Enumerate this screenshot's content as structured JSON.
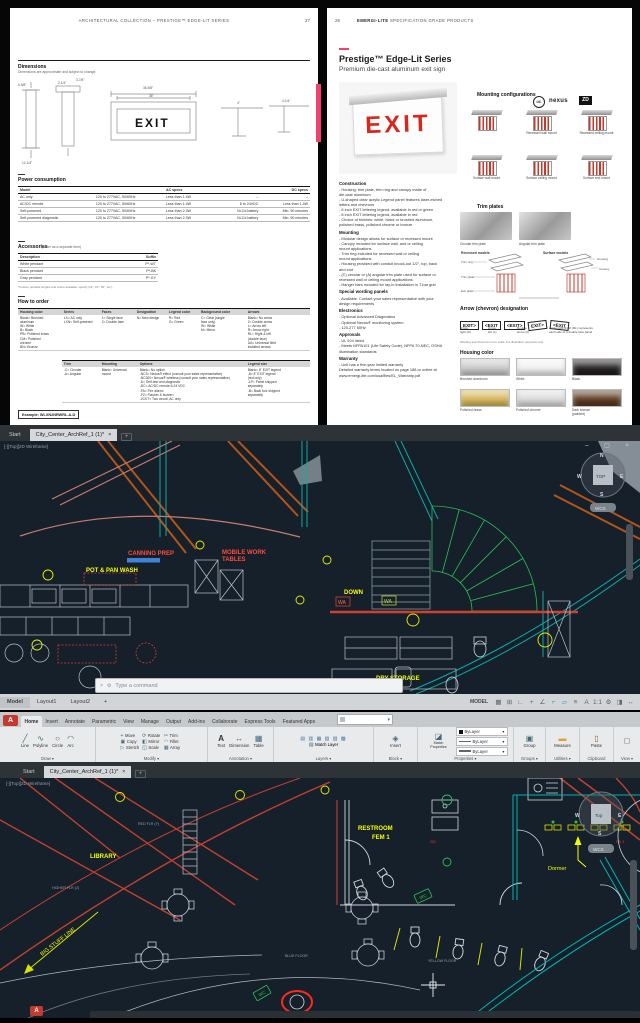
{
  "doc_left": {
    "header": "ARCHITECTURAL COLLECTION – PRESTIGE™ EDGE-LIT SERIES",
    "page_number": "27",
    "dimensions_title": "Dimensions",
    "dimensions_note": "Dimensions are approximate and subject to change.",
    "exit_label": "EXIT",
    "dims": {
      "d1": "6-5/8\"",
      "d2": "2-1/4\"",
      "d3": "36-5/8\"",
      "d4": "36\"",
      "d5": "4\"",
      "d6": "4-1/4\"",
      "d7": "12-1/4\"",
      "d8": "3-7/8\""
    },
    "power": {
      "title": "Power consumption",
      "col_model": "Model",
      "col_ac": "AC specs",
      "col_dc": "DC specs",
      "rows": [
        [
          "AC only",
          "120 to 277VAC, 50/60Hz",
          "Less than 1.4W",
          "–",
          "–"
        ],
        [
          "AC/DC remote",
          "120 to 277VAC, 50/60Hz",
          "Less than 1.4W",
          "6 to 24VDC",
          "Less than 1.4W"
        ],
        [
          "Self-powered",
          "120 to 277VAC, 50/60Hz",
          "Less than 2.3W",
          "Ni-Cd battery",
          "Min. 90 minutes"
        ],
        [
          "Self-powered diagnostic",
          "120 to 277VAC, 50/60Hz",
          "Less than 2.3W",
          "Ni-Cd battery",
          "Min. 90 minutes"
        ]
      ]
    },
    "accessories": {
      "title": "Accessories",
      "title_note": "(order as a separate item)",
      "col_desc": "Description",
      "col_suffix": "Suffix",
      "rows": [
        [
          "White pendant",
          "P*-WT"
        ],
        [
          "Black pendant",
          "P*-BK"
        ],
        [
          "Gray pendant",
          "P*-GY"
        ]
      ],
      "footnote": "*Custom pendant lengths and colors available, specify (12\", 24\", 36\", etc.)"
    },
    "order": {
      "title": "How to order",
      "cols": [
        {
          "h": "Housing color",
          "b": "Blank= Brushed\n aluminum\nW= White\nB= Black\nPB= Polished brass\nCM= Polished\n chrome\nBN= Bronze"
        },
        {
          "h": "Series",
          "b": "LX= AC only\nLXN= Self-powered"
        },
        {
          "h": "Faces",
          "b": "1= Single face\n2= Double face"
        },
        {
          "h": "Designation",
          "b": "N= New design"
        },
        {
          "h": "Legend color",
          "b": "R= Red\nG= Green"
        },
        {
          "h": "Background color",
          "b": "C= Clear (single\n face only)\nW= White\nM= Mirror"
        },
        {
          "h": "Arrows",
          "b": "Blank= No arrow\n2= Double arrow\nL= Arrow left\nR= Arrow right\nRL= Right & left\n (double face)\nUA= Universal field\n installed arrows"
        }
      ],
      "cols2": [
        {
          "h": "Trim",
          "b": "-C= Circular\n-A= Angular"
        },
        {
          "h": "Mounting",
          "b": "Blank= Universal\n mount"
        },
        {
          "h": "Options",
          "b": "Blank= No option\n-NC3= Nexus® effect (consult your sales representative)\n-NC300= Nexus® wireless (consult your sales representative)\n-D= Self-test and diagnostic\n-DC= AC/DC remote 6-24 VDC\n-FA= Fire alarm²\n-FZ= Flasher & buzzer²\n-2CKT= Two circuit, AC only"
        },
        {
          "h": "Legend size",
          "b": "Blank= 6\" EXIT legend\n-8= 8\" EXIT legend\n (red only)\n-LP= Panel shipped\n separately\n-B= Back box shipped\n separately"
        }
      ],
      "example": "Example: WLXN2NRWRL-A-D"
    }
  },
  "doc_right": {
    "page_number": "26",
    "header_bold": "EMERGI-LITE",
    "header_rest": " SPECIFICATION GRADE PRODUCTS",
    "title": "Prestige™ Edge-Lit Series",
    "subtitle": "Premium die-cast aluminum exit sign",
    "exit_label": "EXIT",
    "logos": {
      "ul": "UL",
      "nexus": "nexus",
      "zd": "ZD"
    },
    "mounting_title": "Mounting configurations",
    "mounting_captions": [
      "",
      "Recessed wall mount",
      "Recessed ceiling mount",
      "Surface wall mount",
      "Surface ceiling mount",
      "Surface end mount"
    ],
    "sections": [
      {
        "title": "Construction",
        "body": "- Housing, trim plate, trim ring and canopy made of\n  die-cast aluminum\n- U-shaped clear acrylic Legend panel features laser-etched\n  letters and chevrons\n- 6 inch EXIT lettering legend, available in red or green\n- 8 inch EXIT lettering legend, available in red\n- Choice of finishes: white, black or brushed aluminum,\n  polished brass, polished chrome or bronze"
      },
      {
        "title": "Mounting",
        "body": "- Modular design allows for surface or recessed mount\n- Canopy included for surface wall, and or ceiling\n  mount applications\n- Trim ring included for recessed wall or ceiling\n  mount applications\n- Housing provided with conduit knock-out 1/2\", top, back\n  and end\n- (C) circular or (A) angular trim plate used for surface or\n  recessed wall or ceiling mount applications\n- Hanger bars included for lay-in installation in T-bar grid"
      },
      {
        "title": "Special wording panels",
        "body": "- Available. Contact your sales representative with your\n  design requirements"
      },
      {
        "title": "Electronics",
        "body": "- Optional Advanced Diagnostics\n- Optional Nexus® monitoring system\n- 120-277 60Hz"
      },
      {
        "title": "Approvals",
        "body": "- UL 924 listed\n- Meets NFPA101 (Life Safety Code), NFPA 70-NEC, OSHA\n  illumination standards"
      },
      {
        "title": "Warranty",
        "body": "- Unit has a five-year limited warranty\n  Detailed warranty terms located on page 188 or online at\n  www.emergi-lite.com/usa/files/EL_Warranty.pdf"
      }
    ],
    "trim_title": "Trim plates",
    "trim_captions": [
      "Circular trim plate",
      "Angular trim plate"
    ],
    "models_labels": [
      "Recessed models",
      "Surface models"
    ],
    "callouts": [
      "Trim ring",
      "Trim plate",
      "Exit plate",
      "Housing",
      "Canopy"
    ],
    "arrow_title": "Arrow (chevron) designation",
    "arrow_signs": [
      "EXIT>",
      "<EXIT",
      "<EXIT>",
      "EXIT>",
      "<EXIT"
    ],
    "arrow_captions": [
      "Arrow\nright (R)",
      "Arrow\nleft (L)",
      "Double\narrow (2)",
      "Arrow right & left (RL) represents\neach side of a double face panel"
    ],
    "arrow_note": "Wording and chevrons not to scale. For illustration purposes only.",
    "housing_title": "Housing color",
    "swatches": [
      {
        "label": "Brushed aluminum",
        "color": "#c9c9c9"
      },
      {
        "label": "White",
        "color": "#f2f2f2"
      },
      {
        "label": "Black",
        "color": "#231f20"
      },
      {
        "label": "Polished brass",
        "color": "#d6b65a"
      },
      {
        "label": "Polished chrome",
        "color": "#dcdcdc"
      },
      {
        "label": "Dark bronze\n(painted)",
        "color": "#5d3a22"
      }
    ]
  },
  "cad_mid": {
    "tab_start": "Start",
    "tab_drawing": "City_Center_ArchRef_1 (1)*",
    "tab_close": "×",
    "tab_new": "+",
    "viewport_label": "[-][Top][2D Wireframe]",
    "window_controls": "–  ▢  ×",
    "labels": {
      "canning": "CANNING PREP",
      "potpan": "POT & PAN WASH",
      "mobile1": "MOBILE WORK",
      "mobile2": "TABLES",
      "down": "DOWN",
      "dry": "DRY STORAGE",
      "wa1": "WA",
      "wa2": "WA"
    },
    "viewcube": {
      "n": "N",
      "s": "S",
      "e": "E",
      "w": "W",
      "top": "TOP",
      "wcs": "WCS"
    },
    "command_close": "×",
    "command_gear": "⚙",
    "command_placeholder": "Type a command",
    "status": {
      "model": "Model",
      "layout1": "Layout1",
      "layout2": "Layout2",
      "plus": "+",
      "model_badge": "MODEL"
    },
    "status_icons": [
      "▦",
      "⊞",
      "∟",
      "+",
      "∠",
      "⌐",
      "▱",
      "≡",
      "A",
      "1:1",
      "⚙",
      "◨",
      "↔"
    ]
  },
  "cad_bottom": {
    "ribbon_tabs": [
      "Home",
      "Insert",
      "Annotate",
      "Parametric",
      "View",
      "Manage",
      "Output",
      "Add-ins",
      "Collaborate",
      "Express Tools",
      "Featured Apps"
    ],
    "panels": [
      {
        "label": "Draw ▾",
        "items": [
          "Line",
          "Polyline",
          "Circle",
          "Arc"
        ]
      },
      {
        "label": "Modify ▾",
        "items": [
          "Move",
          "Copy",
          "Stretch",
          "Rotate",
          "Mirror",
          "Scale",
          "Trim",
          "Fillet",
          "Array"
        ]
      },
      {
        "label": "Annotation ▾",
        "items": [
          "Text",
          "Dimension",
          "Table"
        ]
      },
      {
        "label": "Layers ▾",
        "items": [
          "Match Layer"
        ]
      },
      {
        "label": "Block ▾",
        "items": [
          "Insert"
        ]
      },
      {
        "label": "Properties ▾",
        "items": [
          "Match Properties",
          "ByLayer",
          "ByLayer",
          "ByLayer"
        ]
      },
      {
        "label": "Groups ▾",
        "items": [
          "Group"
        ]
      },
      {
        "label": "Utilities ▾",
        "items": [
          "Measure"
        ]
      },
      {
        "label": "Clipboard",
        "items": [
          "Paste"
        ]
      },
      {
        "label": "View ▾",
        "items": []
      }
    ],
    "tab_start": "Start",
    "tab_drawing": "City_Center_ArchRef_1 (1)*",
    "tab_close": "×",
    "tab_new": "+",
    "viewport_label": "[-][Top][2D Wireframe]",
    "app_logo": "A",
    "labels": {
      "library": "LIBRARY",
      "restroom1": "RESTROOM",
      "restroom2": "FEM 1",
      "dormer": "Dormer",
      "bigstuff": "BIG STUFF LINE",
      "redflr": "RED FLR (Y)",
      "higherflr": "HIGHER FLR (2)",
      "bluefloor": "BLUE FLOOR",
      "yellowfloor": "YELLOW FLOOR",
      "fs1": "FS-1",
      "gd": "GD",
      "wc1": "WC",
      "wc2": "WC"
    },
    "viewcube": {
      "w": "W",
      "e": "E",
      "s": "S",
      "top": "Top",
      "wcs": "WCS"
    }
  }
}
